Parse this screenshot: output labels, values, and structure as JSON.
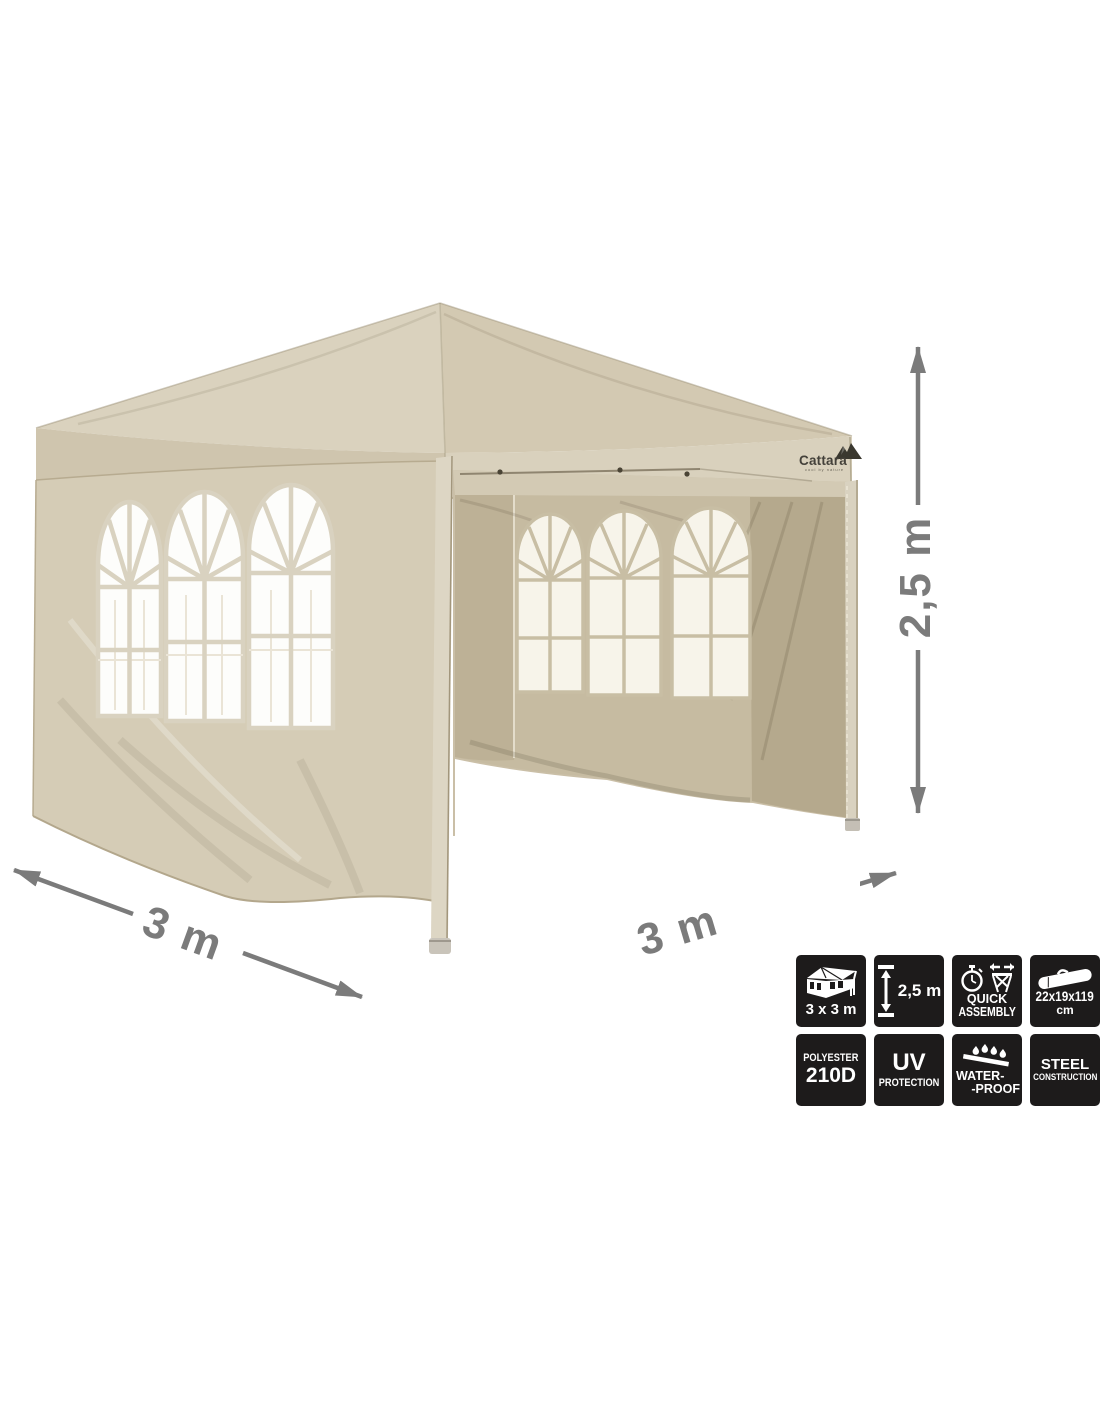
{
  "product": {
    "brand": "Cattara",
    "brand_tagline": "cool by nature"
  },
  "dimensions": {
    "width_label": "3 m",
    "depth_label": "3 m",
    "height_label": "2,5 m"
  },
  "colors": {
    "canvas_light": "#dad2be",
    "canvas_mid": "#d3c9b2",
    "canvas_shadow": "#b5a98d",
    "window_glow": "#f7f4ea",
    "dimension_gray": "#7b7b7b",
    "badge_bg": "#1d1b1b",
    "badge_text": "#ffffff"
  },
  "features": [
    {
      "icon": "gazebo-icon",
      "lines": [
        "3 x 3 m"
      ]
    },
    {
      "icon": "height-arrow-icon",
      "lines": [
        "2,5 m"
      ]
    },
    {
      "icon": "quick-assembly-icon",
      "lines": [
        "QUICK",
        "ASSEMBLY"
      ]
    },
    {
      "icon": "carry-bag-icon",
      "lines": [
        "22x19x119",
        "cm"
      ]
    },
    {
      "icon": "none",
      "lines": [
        "POLYESTER",
        "210D"
      ]
    },
    {
      "icon": "none",
      "lines": [
        "UV",
        "PROTECTION"
      ]
    },
    {
      "icon": "water-drops-icon",
      "lines": [
        "WATER-",
        "-PROOF"
      ]
    },
    {
      "icon": "none",
      "lines": [
        "STEEL",
        "CONSTRUCTION"
      ]
    }
  ]
}
